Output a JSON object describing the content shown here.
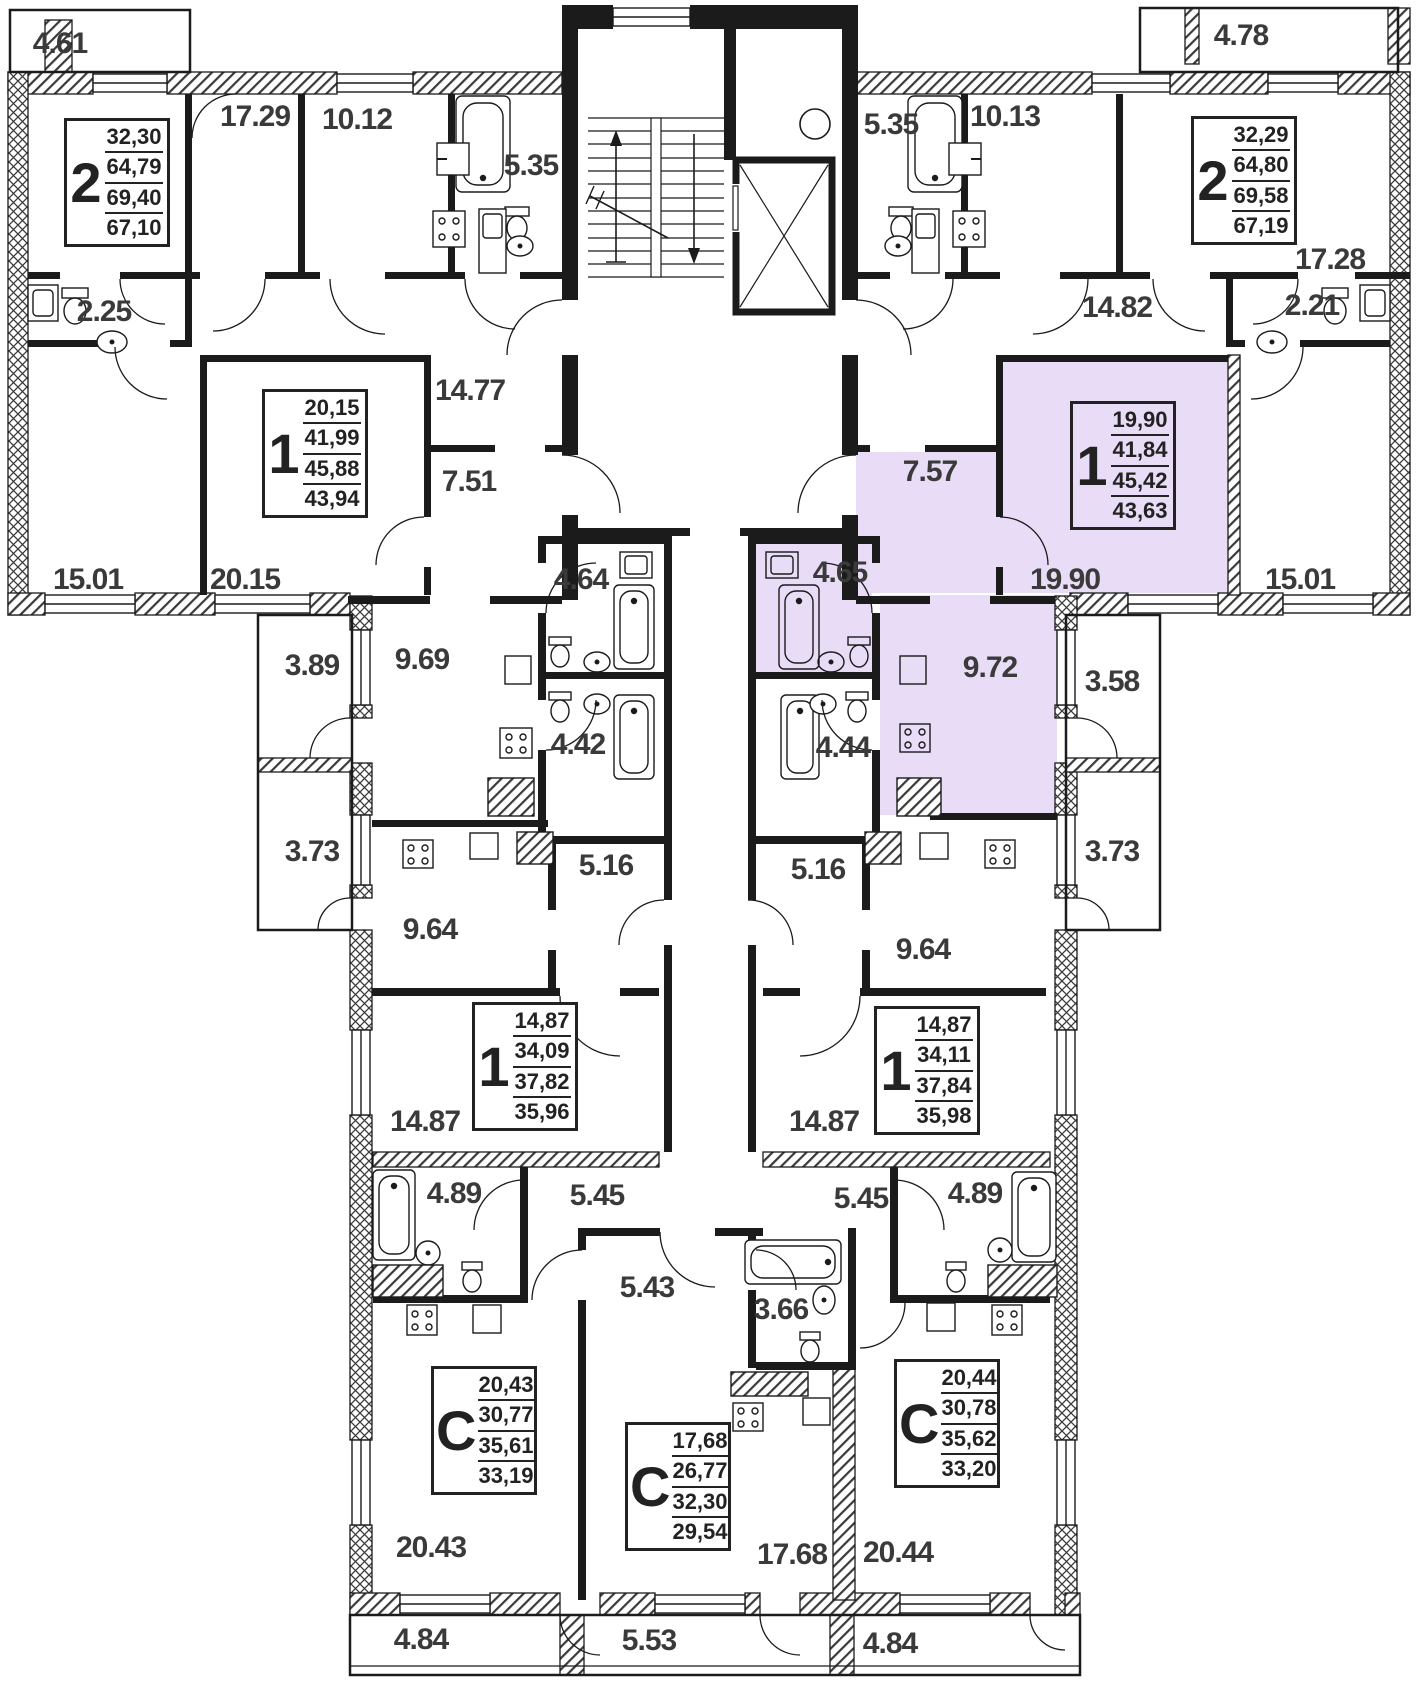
{
  "plan": {
    "kind": "residential-floor-plan",
    "highlight_color": "#e9dcf7",
    "wall_color": "#1b1b1b",
    "labels": [
      {
        "text": "4.61"
      },
      {
        "text": "17.29"
      },
      {
        "text": "10.12"
      },
      {
        "text": "5.35"
      },
      {
        "text": "5.35"
      },
      {
        "text": "10.13"
      },
      {
        "text": "4.78"
      },
      {
        "text": "2.25"
      },
      {
        "text": "14.77"
      },
      {
        "text": "14.82"
      },
      {
        "text": "2.21"
      },
      {
        "text": "17.28"
      },
      {
        "text": "7.51"
      },
      {
        "text": "7.57"
      },
      {
        "text": "15.01"
      },
      {
        "text": "20.15"
      },
      {
        "text": "19.90"
      },
      {
        "text": "15.01"
      },
      {
        "text": "4.64"
      },
      {
        "text": "4.65"
      },
      {
        "text": "9.69"
      },
      {
        "text": "3.89"
      },
      {
        "text": "9.72"
      },
      {
        "text": "3.58"
      },
      {
        "text": "4.42"
      },
      {
        "text": "4.44"
      },
      {
        "text": "3.73"
      },
      {
        "text": "3.73"
      },
      {
        "text": "5.16"
      },
      {
        "text": "5.16"
      },
      {
        "text": "9.64"
      },
      {
        "text": "9.64"
      },
      {
        "text": "14.87"
      },
      {
        "text": "14.87"
      },
      {
        "text": "4.89"
      },
      {
        "text": "5.45"
      },
      {
        "text": "5.45"
      },
      {
        "text": "4.89"
      },
      {
        "text": "5.43"
      },
      {
        "text": "3.66"
      },
      {
        "text": "20.43"
      },
      {
        "text": "17.68"
      },
      {
        "text": "20.44"
      },
      {
        "text": "4.84"
      },
      {
        "text": "5.53"
      },
      {
        "text": "4.84"
      }
    ],
    "cards": [
      {
        "type": "2",
        "areas": [
          "32,30",
          "64,79",
          "69,40",
          "67,10"
        ],
        "highlighted": false
      },
      {
        "type": "2",
        "areas": [
          "32,29",
          "64,80",
          "69,58",
          "67,19"
        ],
        "highlighted": false
      },
      {
        "type": "1",
        "areas": [
          "20,15",
          "41,99",
          "45,88",
          "43,94"
        ],
        "highlighted": false
      },
      {
        "type": "1",
        "areas": [
          "19,90",
          "41,84",
          "45,42",
          "43,63"
        ],
        "highlighted": true
      },
      {
        "type": "1",
        "areas": [
          "14,87",
          "34,09",
          "37,82",
          "35,96"
        ],
        "highlighted": false
      },
      {
        "type": "1",
        "areas": [
          "14,87",
          "34,11",
          "37,84",
          "35,98"
        ],
        "highlighted": false
      },
      {
        "type": "C",
        "areas": [
          "20,43",
          "30,77",
          "35,61",
          "33,19"
        ],
        "highlighted": false
      },
      {
        "type": "C",
        "areas": [
          "17,68",
          "26,77",
          "32,30",
          "29,54"
        ],
        "highlighted": false
      },
      {
        "type": "C",
        "areas": [
          "20,44",
          "30,78",
          "35,62",
          "33,20"
        ],
        "highlighted": false
      }
    ],
    "fixtures": [
      "bathtub-icon",
      "toilet-icon",
      "sink-icon",
      "stove-icon",
      "washer-icon",
      "kitchen-sink-icon",
      "counter-icon",
      "stairs-icon",
      "elevator-icon"
    ]
  }
}
